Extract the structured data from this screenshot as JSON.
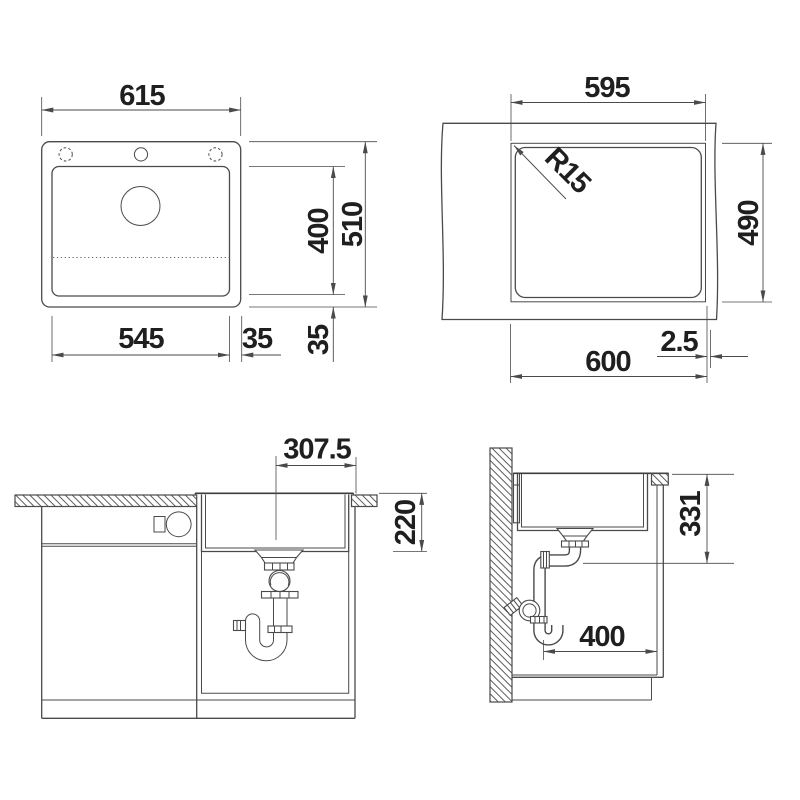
{
  "style": {
    "background": "#ffffff",
    "line_color": "#4a4a4a",
    "text_color": "#1f1f1f"
  },
  "views": {
    "sink_top": {
      "width": "615",
      "total_depth": "510",
      "bowl_depth": "400",
      "bowl_width": "545",
      "side_margin": "35",
      "bottom_margin": "35"
    },
    "cutout": {
      "width": "595",
      "corner_radius": "R15",
      "depth": "490",
      "outer_width": "600",
      "edge_gap": "2.5"
    },
    "front": {
      "drain_center_offset": "307.5",
      "bowl_height": "220"
    },
    "side": {
      "drain_outlet_height": "331",
      "clearance_depth": "400"
    }
  }
}
